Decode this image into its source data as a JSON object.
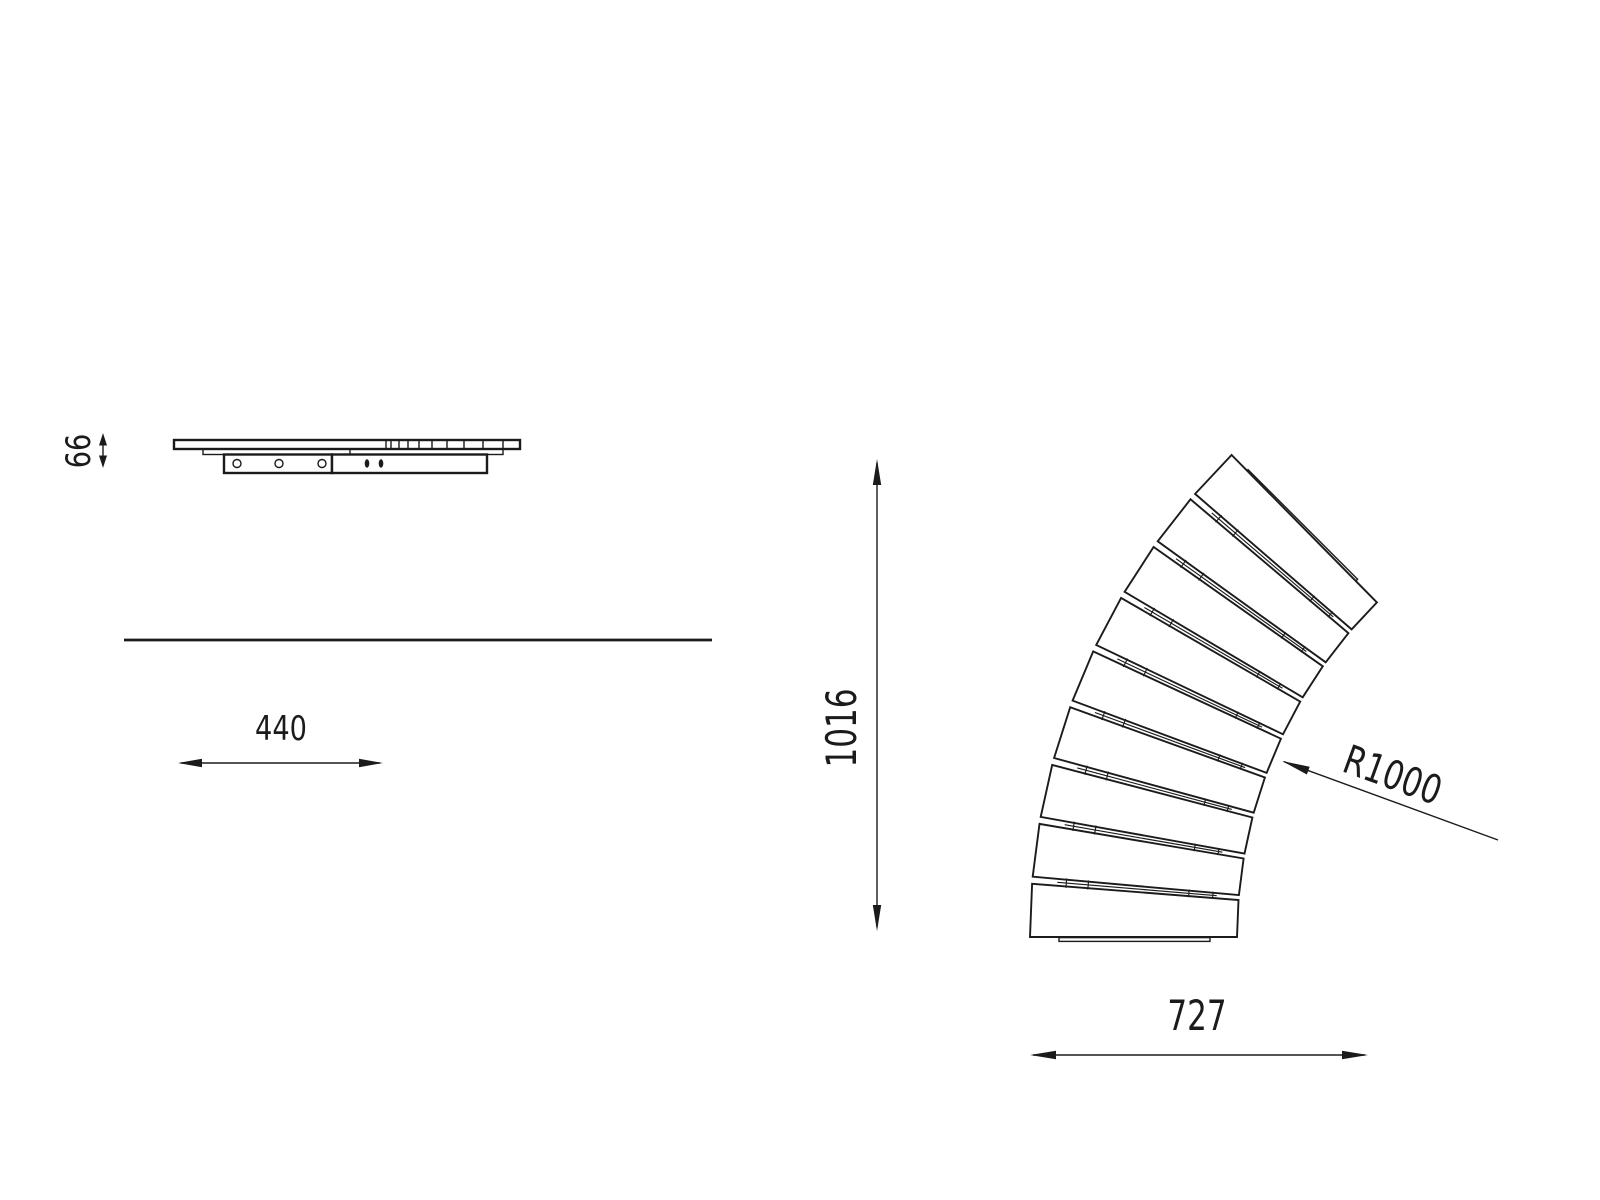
{
  "title": "Curved bench module technical drawing",
  "colors": {
    "background": "#ffffff",
    "line": "#1b1b1b"
  },
  "dimensions": {
    "side_height": "66",
    "side_width": "440",
    "plan_height": "1016",
    "plan_width": "727",
    "plan_radius": "R1000"
  },
  "plan_view": {
    "slat_count": 9,
    "gap_count": 8
  },
  "side_view": {
    "bolt_hole_count": 3,
    "slot_hole_count": 2
  }
}
